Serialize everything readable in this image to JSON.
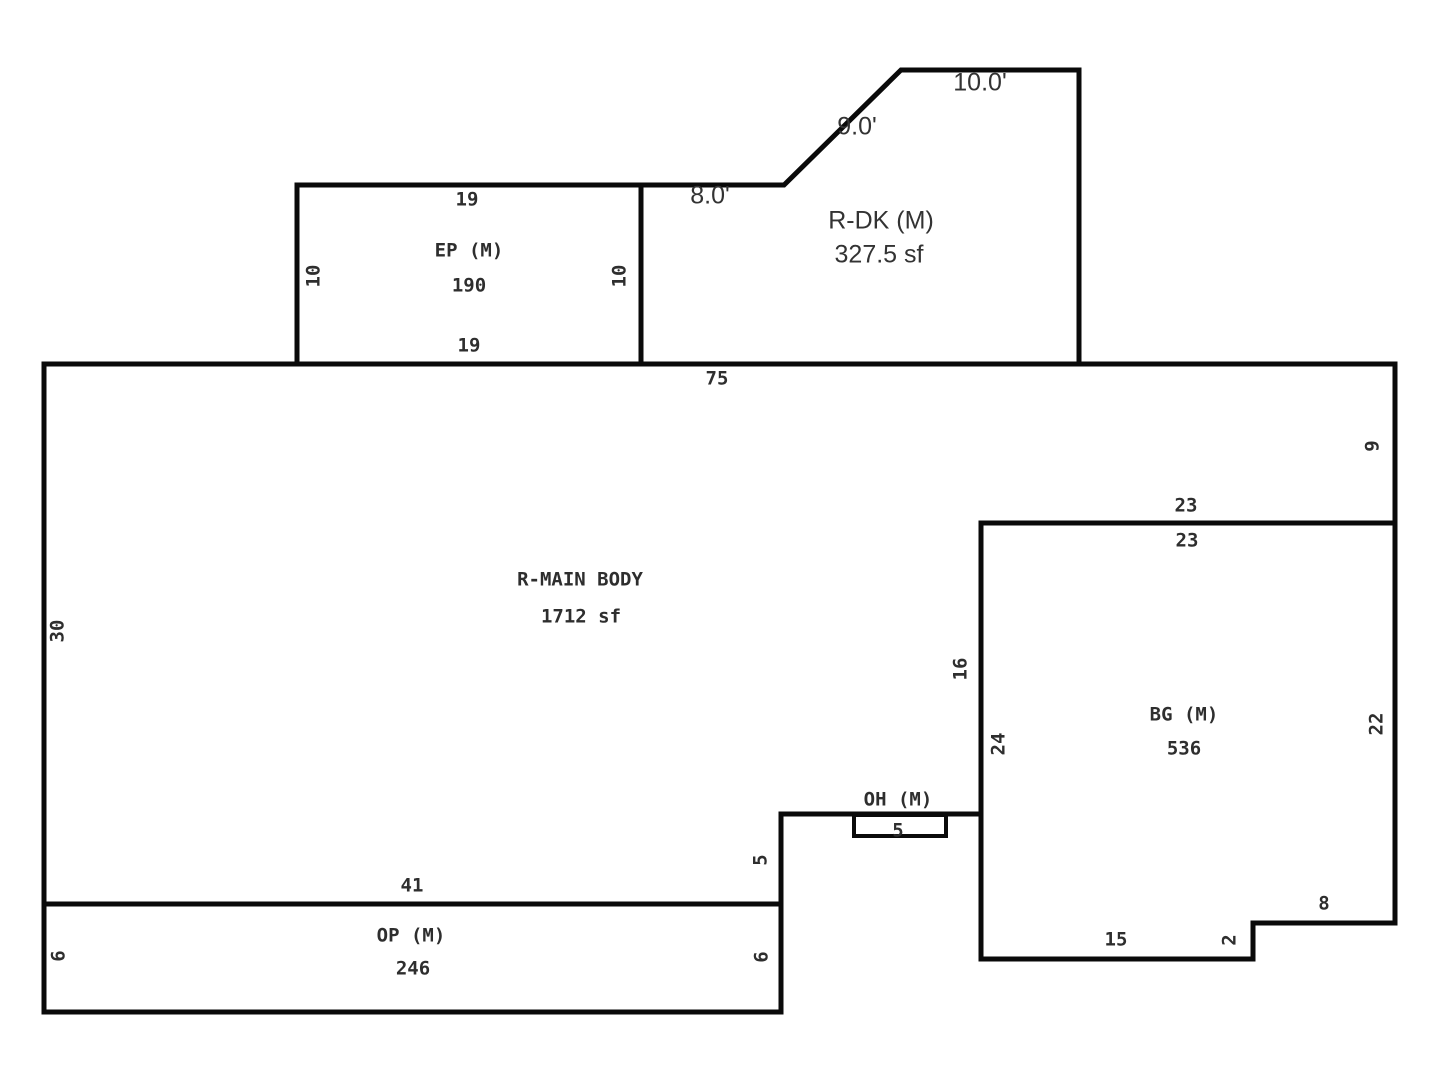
{
  "plan": {
    "background": "#ffffff",
    "line_color": "#0a0a0a",
    "text_color": "#2e2e2e",
    "labels": [
      {
        "name": "ep-top-dim",
        "text": "19",
        "x": 467,
        "y": 200
      },
      {
        "name": "ep-left-dim",
        "text": "10",
        "x": 314,
        "y": 276,
        "rot": true
      },
      {
        "name": "ep-room-name",
        "text": "EP (M)",
        "x": 469,
        "y": 251
      },
      {
        "name": "ep-area-value",
        "text": "190",
        "x": 469,
        "y": 286
      },
      {
        "name": "ep-right-dim",
        "text": "10",
        "x": 620,
        "y": 276,
        "rot": true
      },
      {
        "name": "ep-bottom-dim",
        "text": "19",
        "x": 469,
        "y": 346
      },
      {
        "name": "rdk-left-dim",
        "text": "8.0'",
        "x": 710,
        "y": 196,
        "cls": "sans"
      },
      {
        "name": "rdk-diagonal-dim",
        "text": "9.0'",
        "x": 857,
        "y": 127,
        "cls": "sans"
      },
      {
        "name": "rdk-top-dim",
        "text": "10.0'",
        "x": 980,
        "y": 83,
        "cls": "sans"
      },
      {
        "name": "rdk-room-name",
        "text": "R-DK (M)",
        "x": 881,
        "y": 221,
        "cls": "sans"
      },
      {
        "name": "rdk-area-value",
        "text": "327.5 sf",
        "x": 879,
        "y": 255,
        "cls": "sans"
      },
      {
        "name": "main-top-dim",
        "text": "75",
        "x": 717,
        "y": 379
      },
      {
        "name": "main-left-dim",
        "text": "30",
        "x": 58,
        "y": 631,
        "rot": true
      },
      {
        "name": "main-right-dim",
        "text": "9",
        "x": 1373,
        "y": 446,
        "rot": true
      },
      {
        "name": "bg-top-dim-outer",
        "text": "23",
        "x": 1186,
        "y": 506
      },
      {
        "name": "bg-top-dim-inner",
        "text": "23",
        "x": 1187,
        "y": 541
      },
      {
        "name": "main-room-name",
        "text": "R-MAIN BODY",
        "x": 580,
        "y": 580
      },
      {
        "name": "main-area-value",
        "text": "1712 sf",
        "x": 581,
        "y": 617
      },
      {
        "name": "main-bg-side-dim",
        "text": "16",
        "x": 961,
        "y": 669,
        "rot": true
      },
      {
        "name": "bg-left-dim",
        "text": "24",
        "x": 999,
        "y": 744,
        "rot": true
      },
      {
        "name": "bg-room-name",
        "text": "BG (M)",
        "x": 1184,
        "y": 715
      },
      {
        "name": "bg-area-value",
        "text": "536",
        "x": 1184,
        "y": 749
      },
      {
        "name": "bg-right-dim",
        "text": "22",
        "x": 1377,
        "y": 724,
        "rot": true
      },
      {
        "name": "oh-room-name",
        "text": "OH (M)",
        "x": 898,
        "y": 800
      },
      {
        "name": "oh-width-dim",
        "text": "5",
        "x": 898,
        "y": 831
      },
      {
        "name": "main-step-dim",
        "text": "5",
        "x": 761,
        "y": 860,
        "rot": true
      },
      {
        "name": "main-bottom-dim",
        "text": "41",
        "x": 412,
        "y": 886
      },
      {
        "name": "op-left-dim",
        "text": "6",
        "x": 59,
        "y": 956,
        "rot": true
      },
      {
        "name": "op-room-name",
        "text": "OP (M)",
        "x": 411,
        "y": 936
      },
      {
        "name": "op-area-value",
        "text": "246",
        "x": 413,
        "y": 969
      },
      {
        "name": "op-right-dim",
        "text": "6",
        "x": 762,
        "y": 957,
        "rot": true
      },
      {
        "name": "bg-bottom-dim",
        "text": "15",
        "x": 1116,
        "y": 940
      },
      {
        "name": "bg-notch-step-dim",
        "text": "2",
        "x": 1230,
        "y": 940,
        "rot": true
      },
      {
        "name": "bg-notch-dim",
        "text": "8",
        "x": 1324,
        "y": 904
      }
    ]
  }
}
